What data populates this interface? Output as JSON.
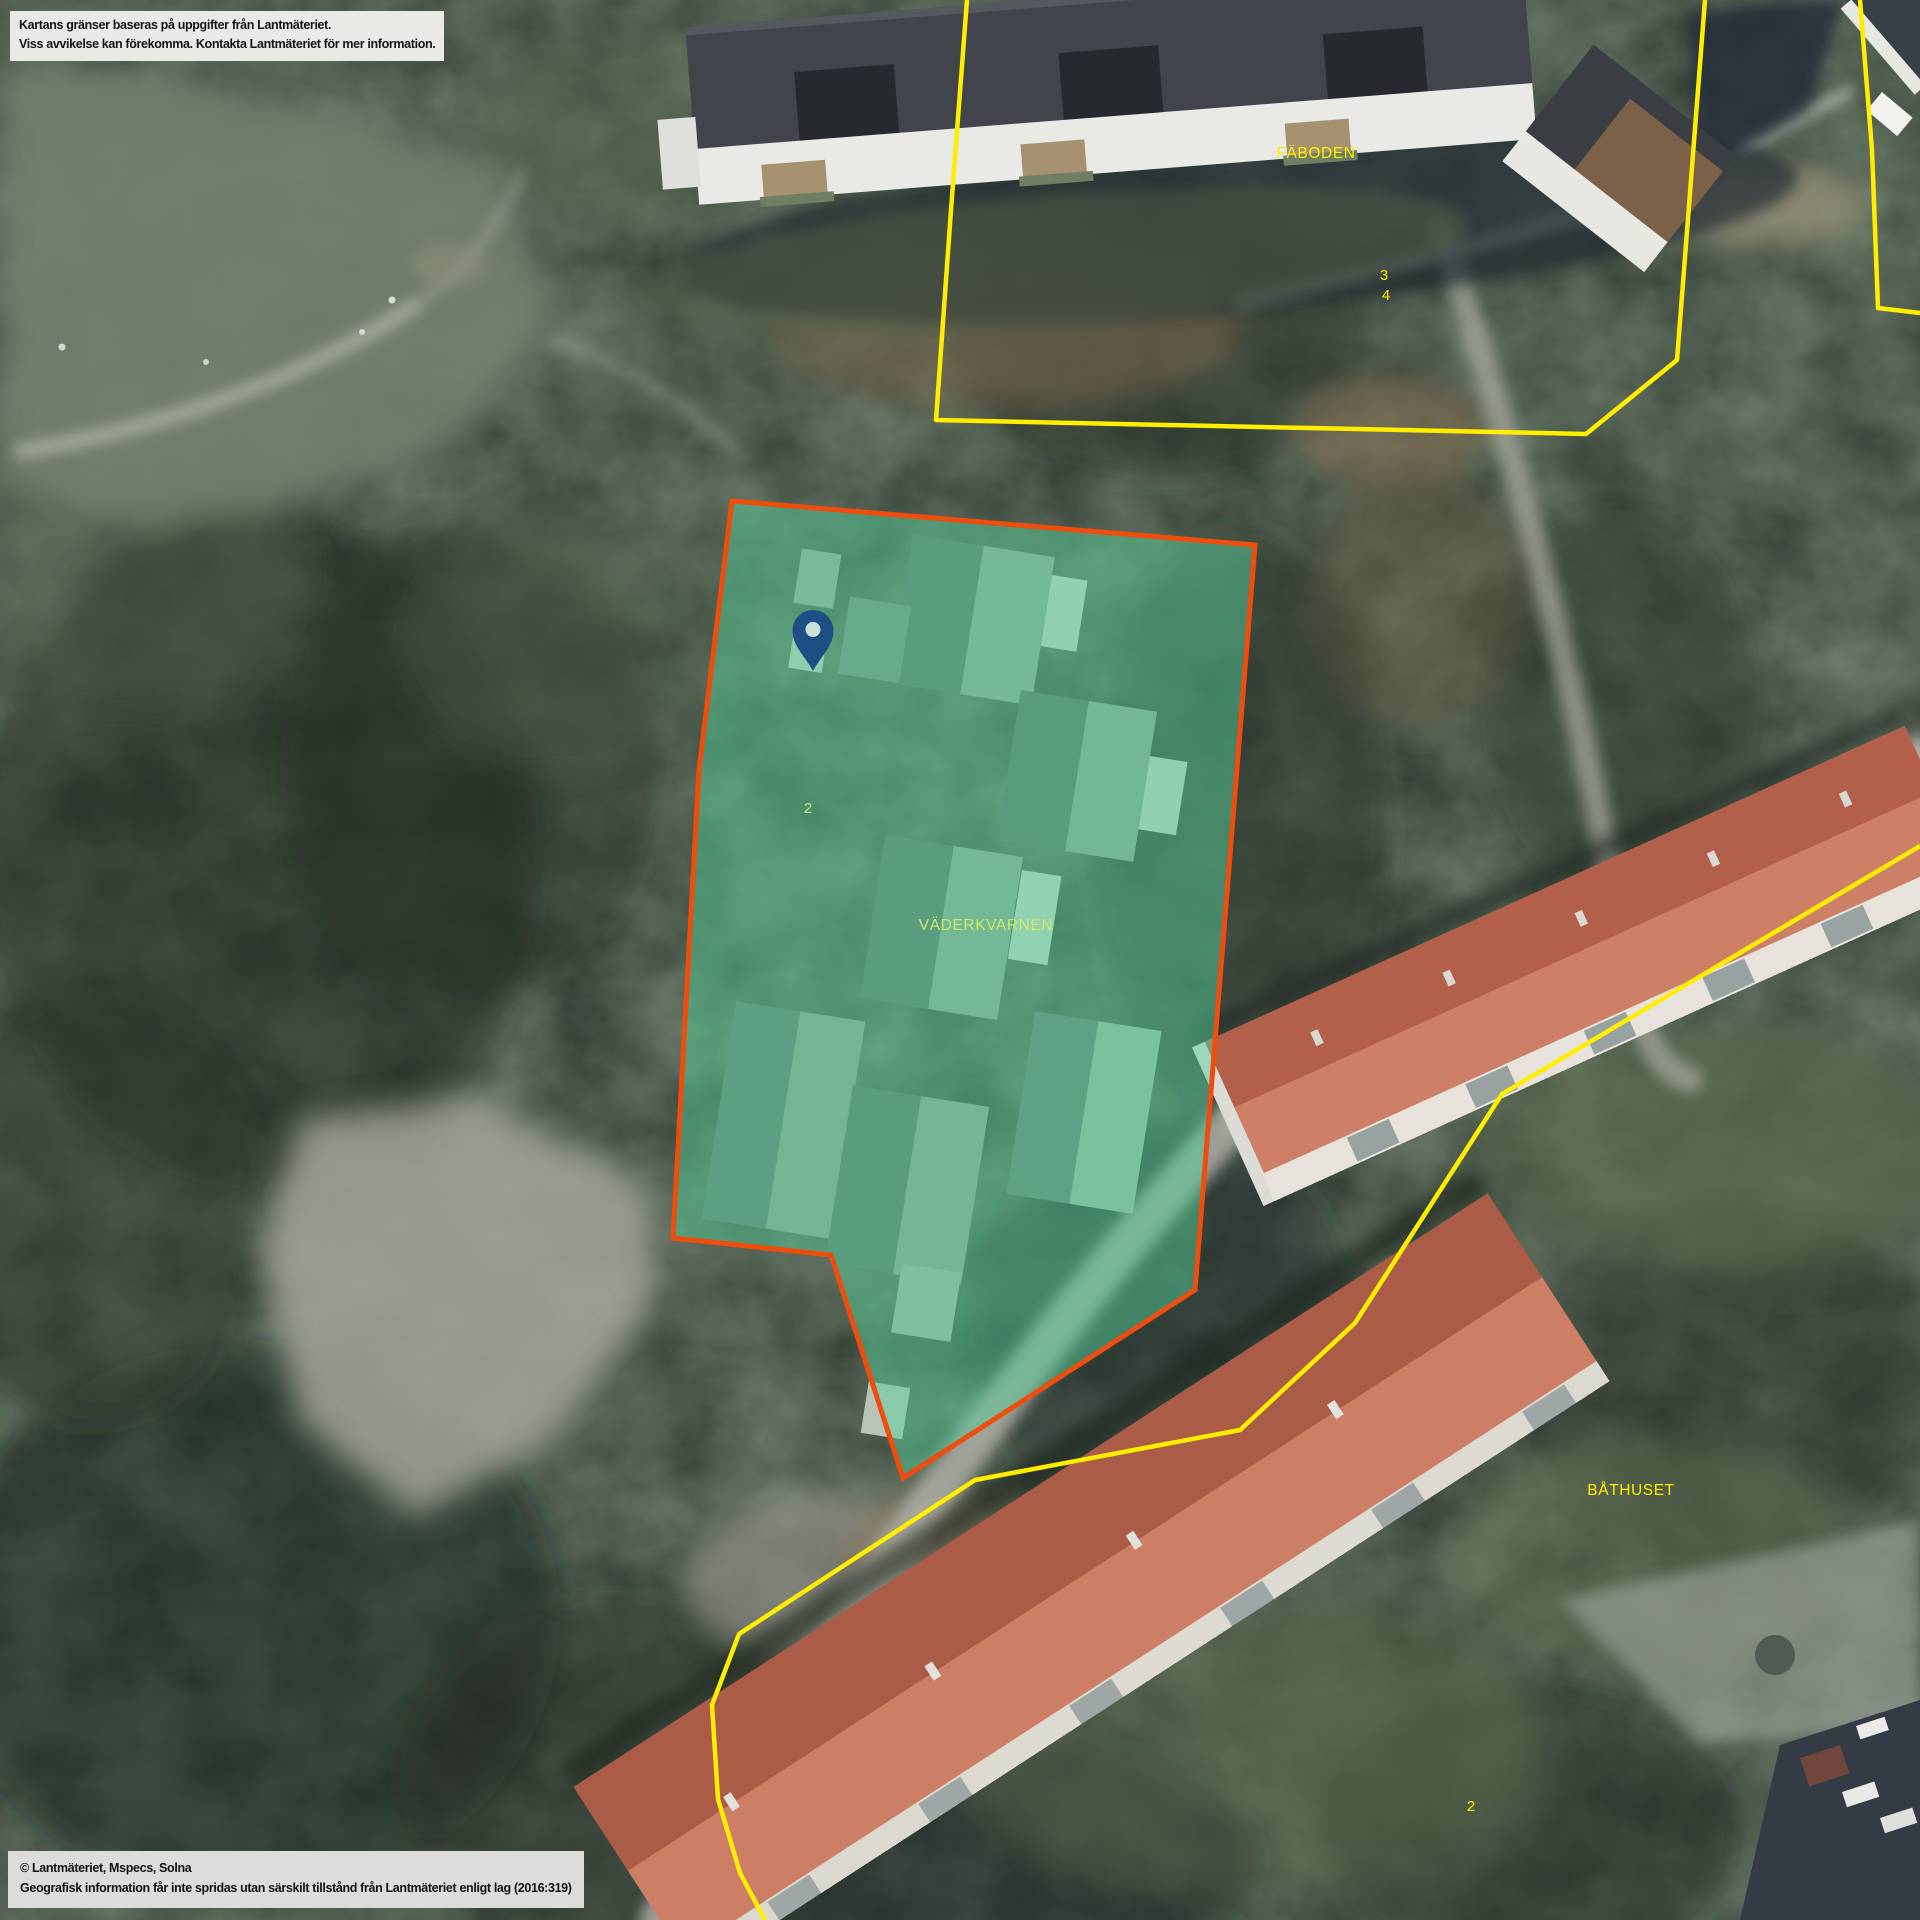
{
  "map": {
    "disclaimer": {
      "line1": "Kartans gränser baseras på uppgifter från Lantmäteriet.",
      "line2": "Viss avvikelse kan förekomma. Kontakta Lantmäteriet för mer information."
    },
    "copyright": {
      "line1": "© Lantmäteriet, Mspecs, Solna",
      "line2": "Geografisk information får inte spridas utan särskilt tillstånd från Lantmäteriet enligt lag (2016:319)"
    },
    "labels": {
      "faboden": "FÄBODEN",
      "faboden_unit_3": "3",
      "faboden_unit_4": "4",
      "vaderkvarnen": "VÄDERKVARNEN",
      "vaderkvarnen_unit": "2",
      "bathuset": "BÅTHUSET",
      "bathuset_unit": "2"
    },
    "colors": {
      "parcel_border": "#ee4d0d",
      "parcel_fill": "#54d29a",
      "boundary_yellow": "#ffee00",
      "label_tinted": "#cdeb68",
      "pin_blue": "#1d4e84",
      "pin_hole": "#cfe2d6"
    }
  }
}
